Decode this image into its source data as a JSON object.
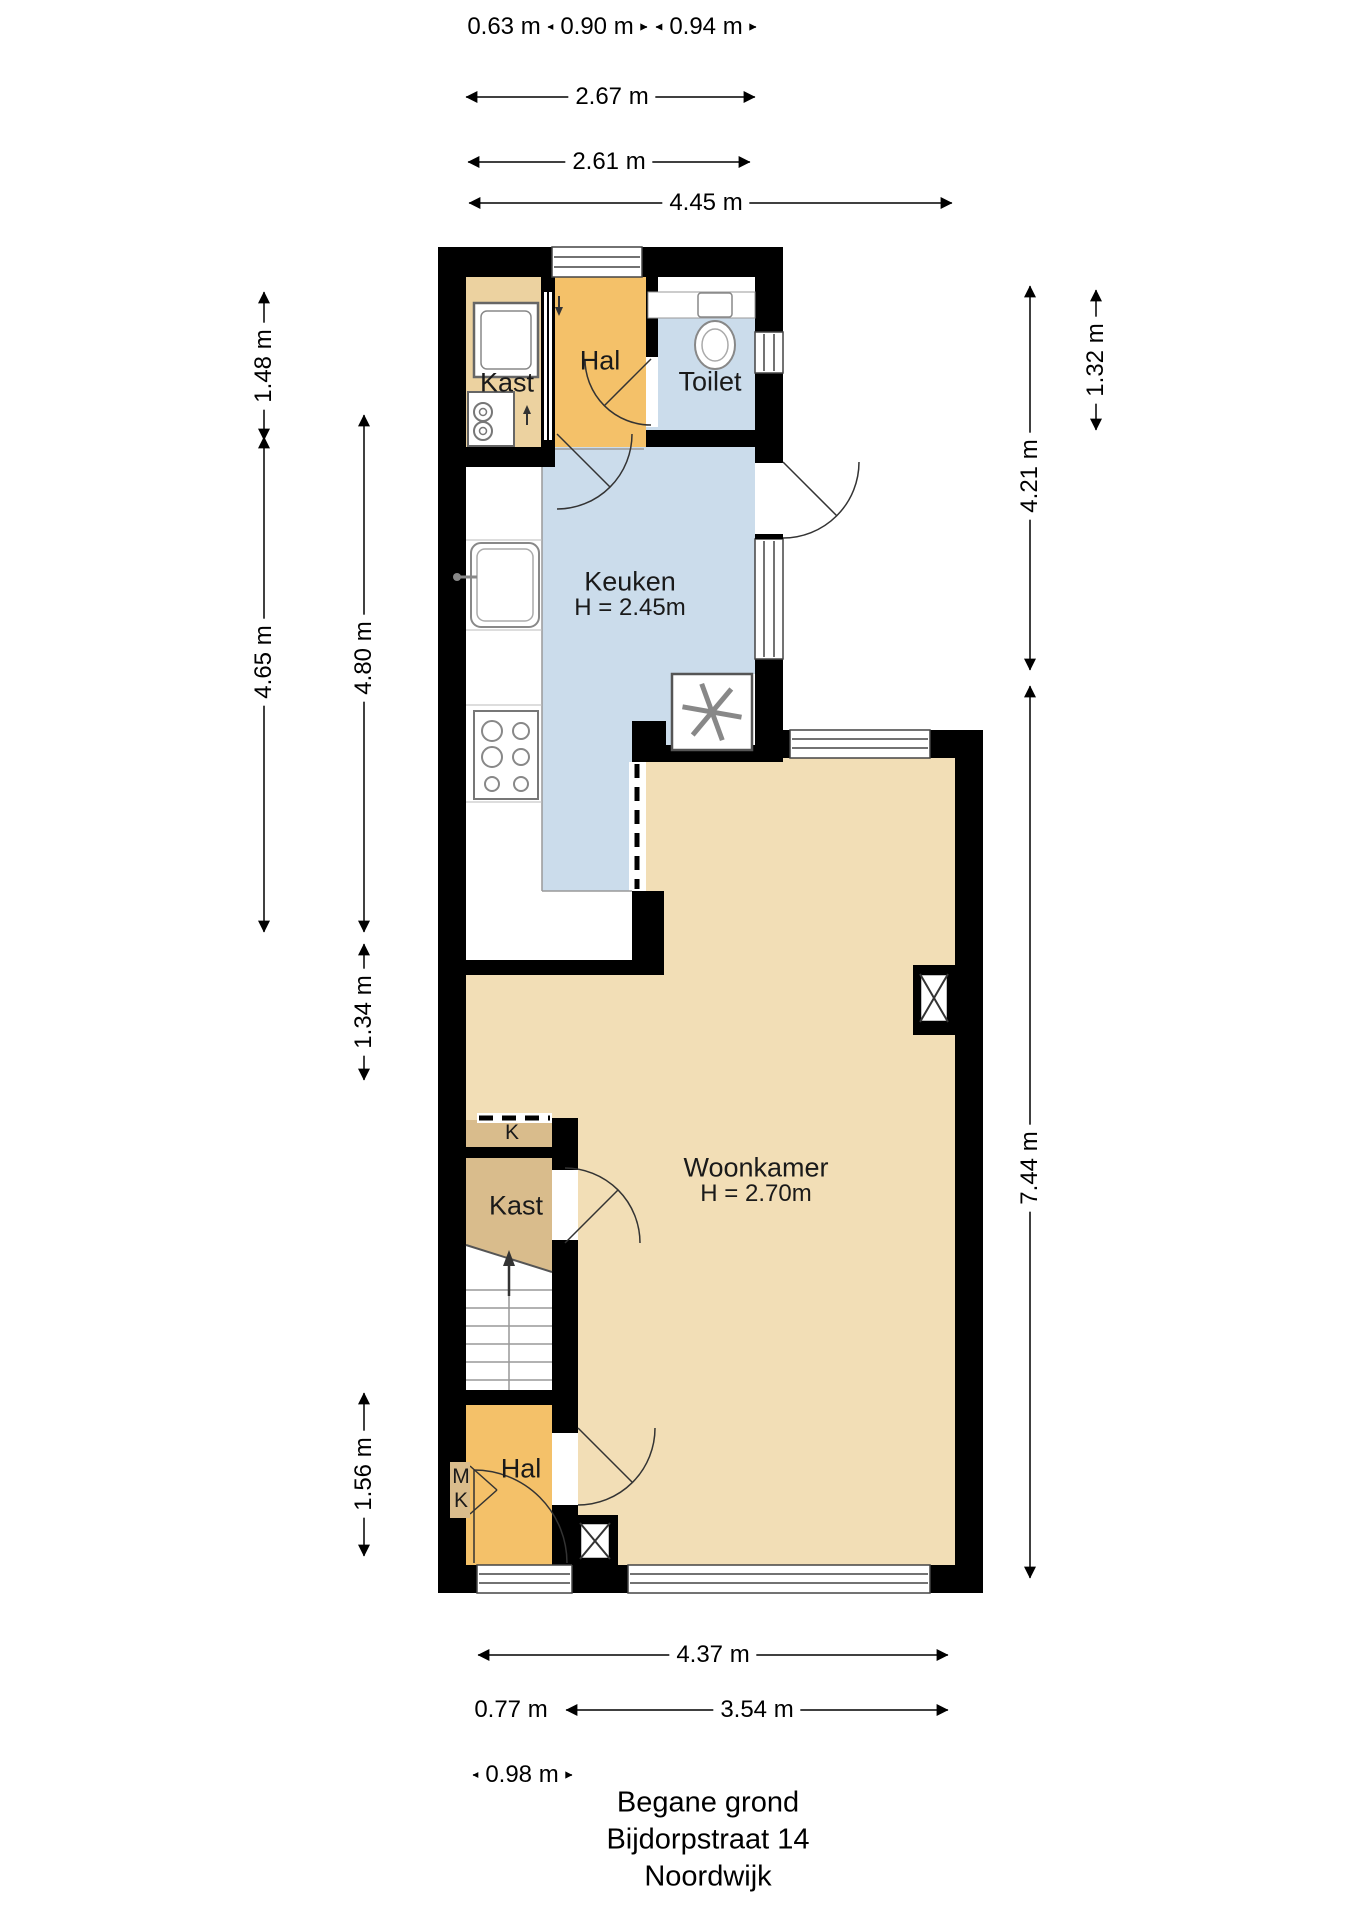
{
  "title": {
    "line1": "Begane grond",
    "line2": "Bijdorpstraat 14",
    "line3": "Noordwijk"
  },
  "rooms": {
    "kast_top": {
      "label": "Kast"
    },
    "hal_top": {
      "label": "Hal"
    },
    "toilet": {
      "label": "Toilet"
    },
    "keuken": {
      "label": "Keuken",
      "height": "H = 2.45m"
    },
    "woonkamer": {
      "label": "Woonkamer",
      "height": "H = 2.70m"
    },
    "k": {
      "label": "K"
    },
    "kast_lower": {
      "label": "Kast"
    },
    "hal_lower": {
      "label": "Hal"
    },
    "mk": {
      "m": "M",
      "k": "K"
    }
  },
  "dimensions": {
    "top": {
      "d1": "0.63 m",
      "d2": "0.90 m",
      "d3": "0.94 m",
      "d4": "2.67 m",
      "d5": "2.61 m",
      "d6": "4.45 m"
    },
    "left": {
      "d1": "1.48 m",
      "d2": "4.65 m",
      "d3": "4.80 m",
      "d4": "1.34 m",
      "d5": "1.56 m"
    },
    "right": {
      "d1": "1.32 m",
      "d2": "4.21 m",
      "d3": "7.44 m"
    },
    "bottom": {
      "d1": "4.37 m",
      "d2": "0.77 m",
      "d3": "3.54 m",
      "d4": "0.98 m"
    }
  },
  "colors": {
    "wall": "#000000",
    "hal": "#F4C169",
    "kast_light": "#ECD2A0",
    "kast": "#D9BC8C",
    "woonkamer": "#F2DEB6",
    "wet_room": "#CBDCEB"
  }
}
